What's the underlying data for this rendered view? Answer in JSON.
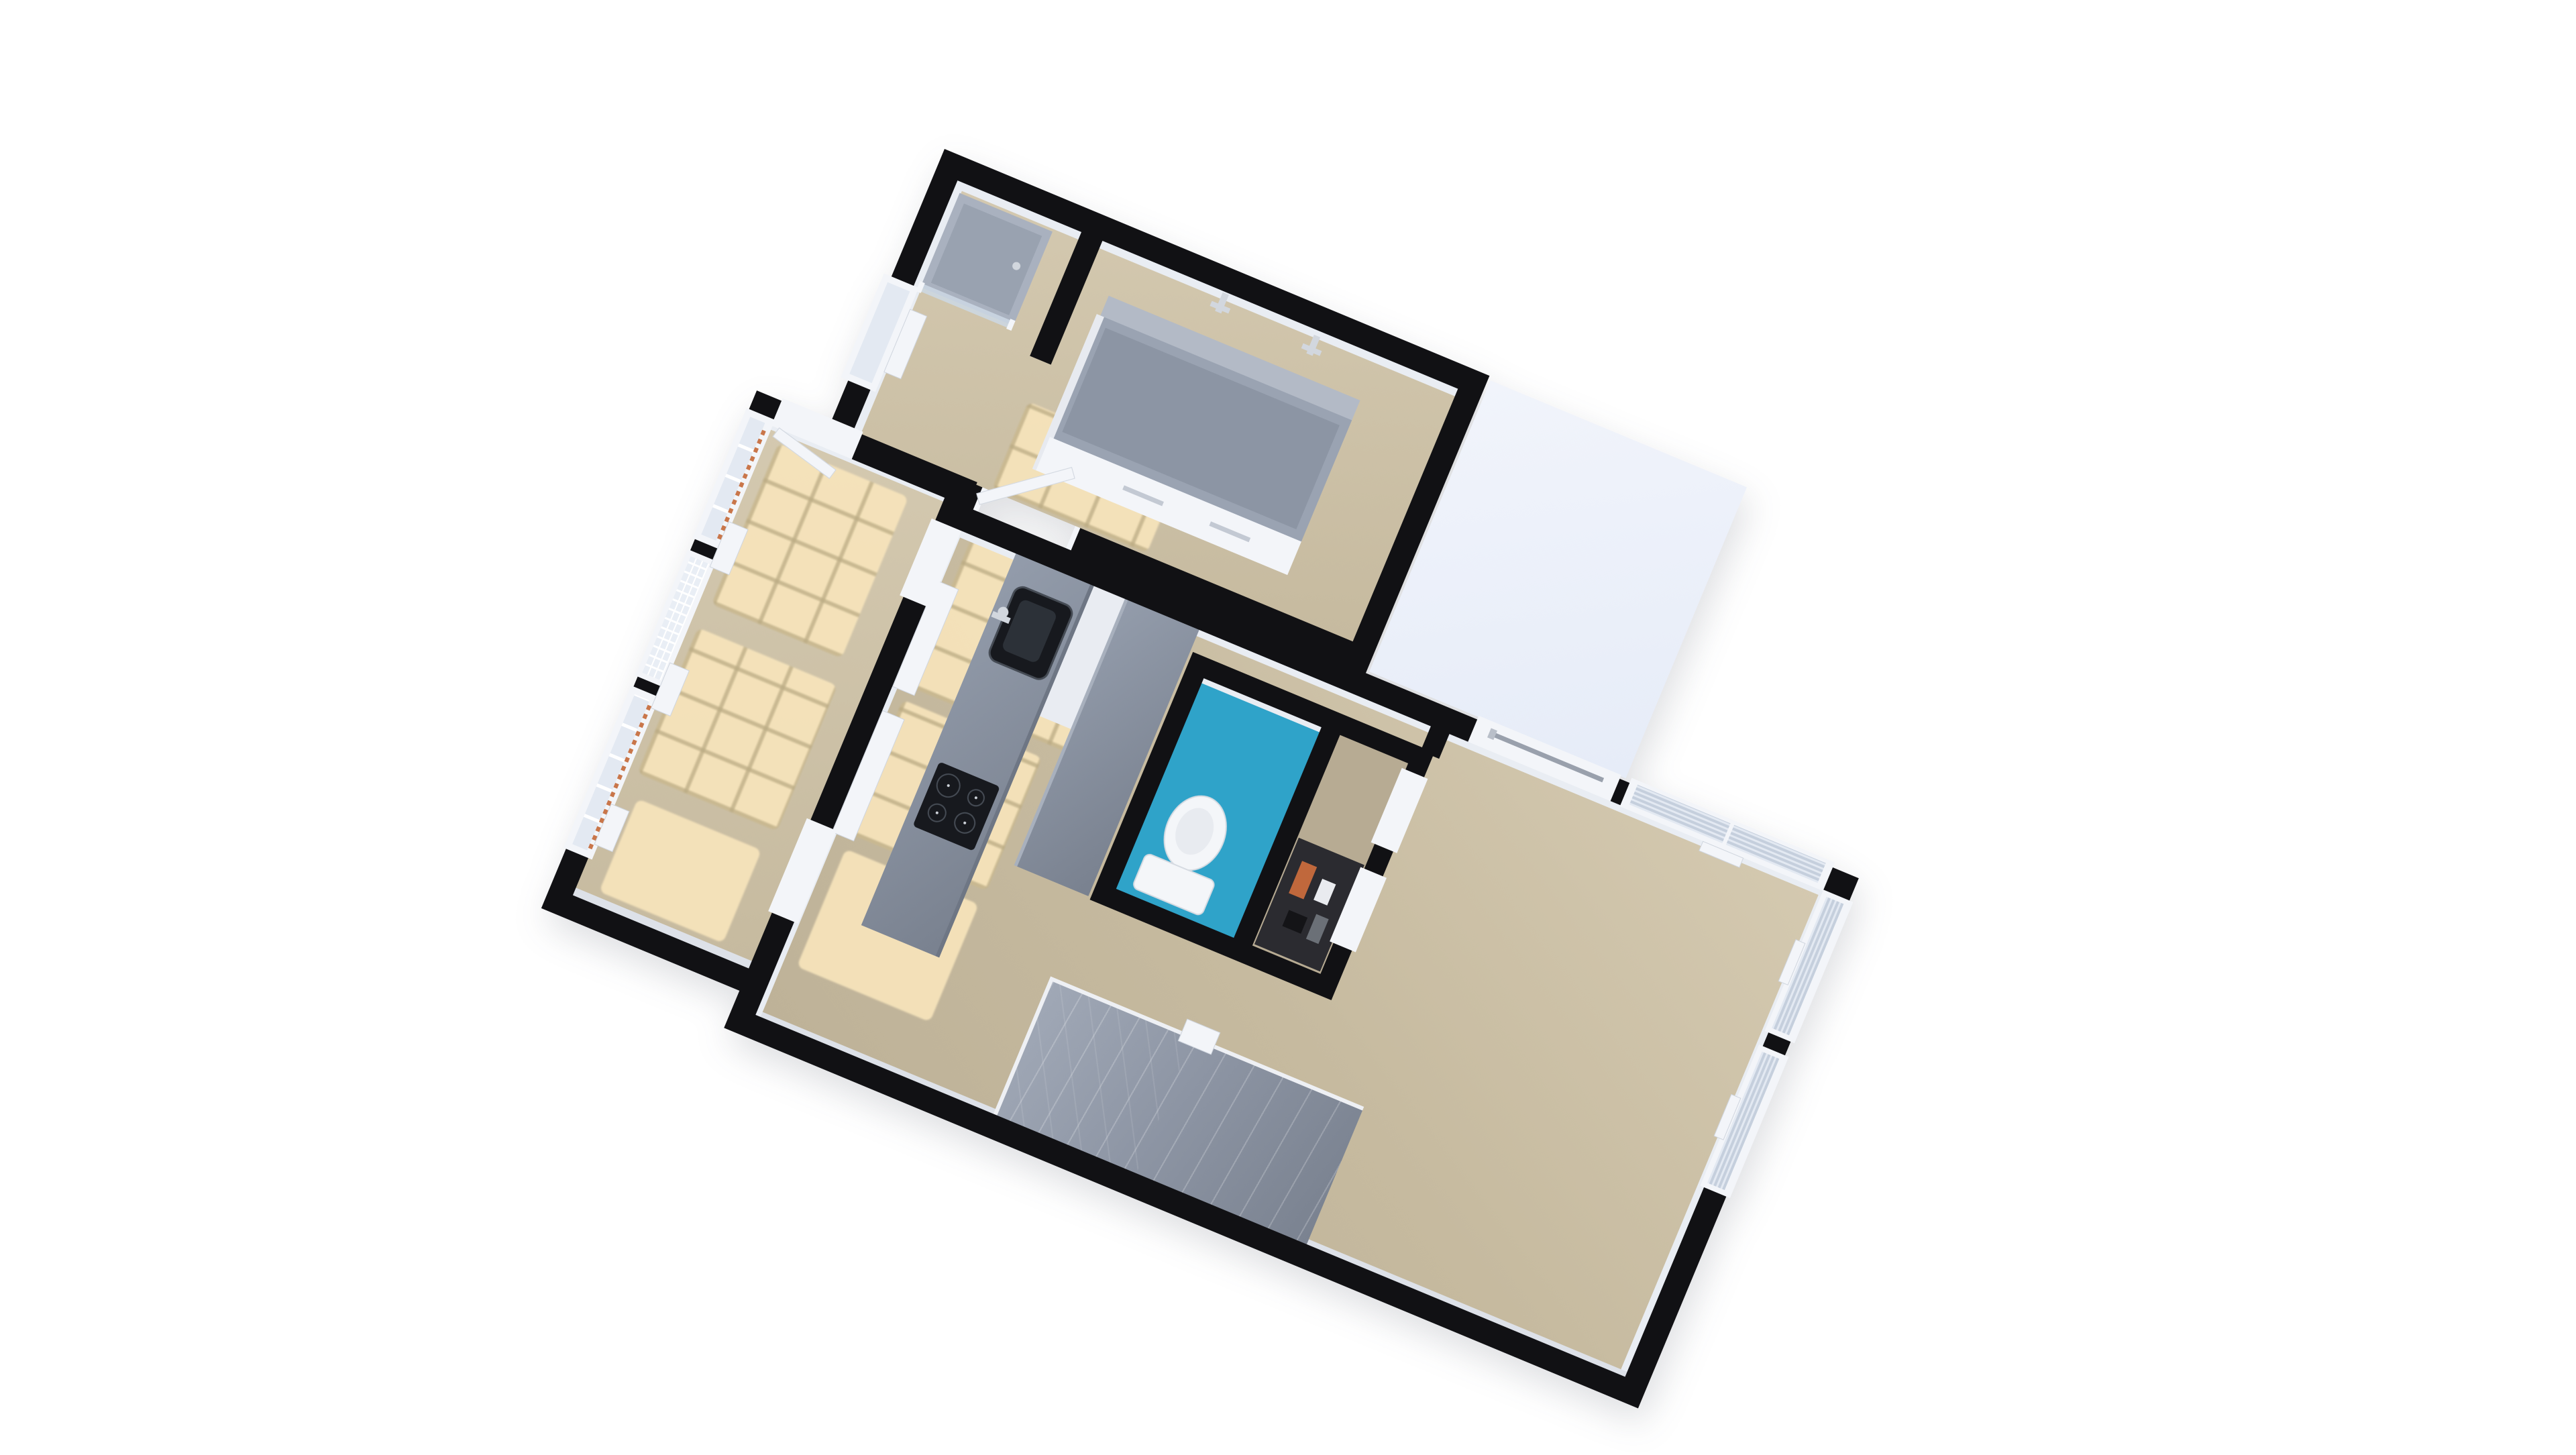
{
  "scene": {
    "type": "3d-floor-plan-render-top-down",
    "background": "#ffffff",
    "plan_rotation_deg": 22.6,
    "visible_text": ""
  },
  "palette": {
    "wall": "#111114",
    "floor_dark": "#c6ba9f",
    "floor_light": "#d4c9b0",
    "sunlight": "#f7e4bb",
    "sun_line": "rgba(186,170,130,0.75)",
    "white": "#f3f5f9",
    "edge": "#cfd5de",
    "glass": "#e3e9f2",
    "slat": "#c5cfdd",
    "counter": "#939cab",
    "counter_dark": "#79818f",
    "appliance": "#17191e",
    "chrome": "#d2d7de",
    "wc_blue": "#2fa3c9",
    "fixture_white": "#f4f6f9",
    "stairs_light": "#a0a8b6",
    "stairs_dark": "#7a8290",
    "terrace": "#f1f4fb",
    "radiator_orange": "#c9764a",
    "closet_dark": "#2b2b30",
    "closet_orange": "#c0683c"
  },
  "rooms": [
    {
      "name": "bathroom",
      "fixtures": [
        "shower-tray",
        "glass-screen",
        "bathtub-vanity-unit",
        "wall-faucet",
        "wall-faucet",
        "window",
        "door"
      ]
    },
    {
      "name": "sunroom",
      "fixtures": [
        "window-wall",
        "radiator-strip",
        "radiator-strip",
        "sill-bench",
        "sill-bench",
        "door-opening"
      ]
    },
    {
      "name": "living-kitchen",
      "fixtures": [
        "kitchen-island-sink",
        "kitchen-island-cooktop",
        "white-counter",
        "wall-radiator",
        "wall-radiator",
        "towel-rail-niche",
        "blind-window",
        "blind-window",
        "blind-window",
        "staircase",
        "newel-post"
      ]
    },
    {
      "name": "wc",
      "fixtures": [
        "toilet",
        "blue-floor"
      ]
    },
    {
      "name": "closet",
      "fixtures": [
        "shelf-items"
      ]
    },
    {
      "name": "terrace",
      "fixtures": []
    }
  ],
  "counts": {
    "sun_patches": 7,
    "window_openings": 8,
    "door_openings": 4
  }
}
